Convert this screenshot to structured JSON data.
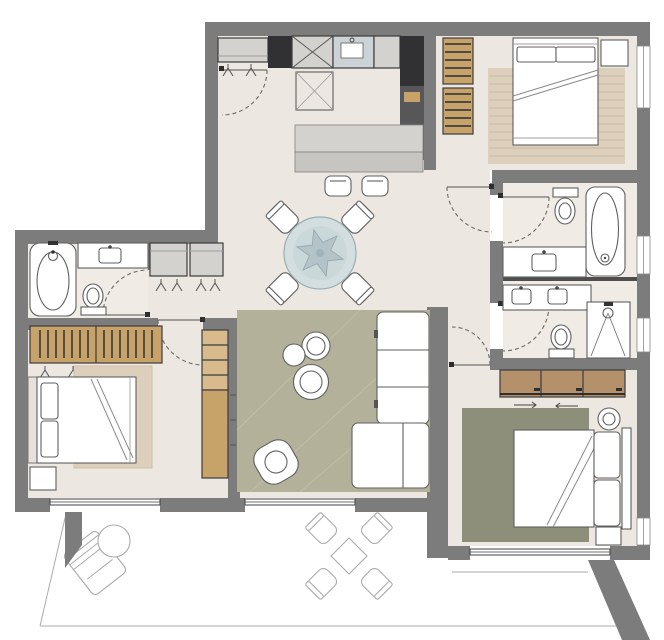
{
  "image": {
    "description": "Top-down architectural floor plan of a three-bedroom apartment with open kitchen-dining-living area, three bathrooms, and a wide terrace along the bottom; rendered with gray walls, cream floors, colored rugs and outlined furniture; no text labels visible",
    "width_px": 664,
    "height_px": 640
  },
  "colors": {
    "wall": "#7c7c7c",
    "wall_dark": "#4e4e4e",
    "floor": "#ece7e0",
    "bath_floor": "#f0ebe4",
    "rug_living": "#b4b19b",
    "rug_master": "#8e8f7b",
    "rug_beige": "#dccfbb",
    "rug_stripe": "#cdbfa7",
    "wood": "#c7a269",
    "wood_light": "#d9ba8c",
    "dresser_wood": "#b5916b",
    "cabinet_dark": "#313133",
    "cabinet_mid": "#57575a",
    "cabinet_gray": "#d4d2ce",
    "cabinet_low": "#c7c5c1",
    "sink_blue": "#cbd3d7",
    "headboard": "#e6e1da",
    "table_top": "#d3dee0",
    "table_inner": "#cbd8da",
    "table_star": "#b4c3c8",
    "glass_line": "#3f3f3f",
    "white": "#ffffff"
  },
  "rooms": [
    {
      "name": "entry-kitchen",
      "features": [
        "entry-door",
        "entry-bench-closet",
        "coat-hooks",
        "refrigerator-column",
        "tall-oven-cabinet-x2",
        "sink-unit",
        "counter",
        "tall-dark-cabinet-column",
        "kitchen-island",
        "bar-stool",
        "bar-stool"
      ]
    },
    {
      "name": "dining-area",
      "features": [
        "round-dining-table-with-star-inlay",
        "dining-chair",
        "dining-chair",
        "dining-chair",
        "dining-chair"
      ]
    },
    {
      "name": "living-area",
      "features": [
        "olive-area-rug",
        "l-shaped-sofa",
        "nesting-coffee-table",
        "nesting-coffee-table",
        "nesting-coffee-table",
        "armchair",
        "terrace-glazing"
      ]
    },
    {
      "name": "bedroom-top-right",
      "features": [
        "double-bed",
        "pillow",
        "pillow",
        "striped-beige-rug",
        "wardrobe-hanging-clothes-x2",
        "nightstand",
        "window"
      ]
    },
    {
      "name": "bathroom-upper-right",
      "features": [
        "toilet",
        "bathtub",
        "vanity-sink",
        "door",
        "window"
      ]
    },
    {
      "name": "shower-room-right",
      "features": [
        "double-vanity",
        "toilet",
        "shower",
        "door",
        "window"
      ]
    },
    {
      "name": "master-bedroom-bottom-right",
      "features": [
        "three-door-dresser",
        "double-bed",
        "pillow",
        "pillow",
        "dark-olive-rug",
        "round-stool",
        "nightstand",
        "terrace-glazing",
        "window"
      ]
    },
    {
      "name": "bedroom-left",
      "features": [
        "wardrobe-hanging-clothes-x2",
        "coat-hooks",
        "double-bed",
        "pillow",
        "pillow",
        "beige-rug",
        "nightstand",
        "shelving-desk-unit",
        "terrace-window"
      ]
    },
    {
      "name": "bathroom-left",
      "features": [
        "bathtub",
        "vanity-sink",
        "toilet",
        "door"
      ]
    },
    {
      "name": "hallway-closets",
      "features": [
        "built-in-closet",
        "built-in-closet",
        "coat-hooks"
      ]
    },
    {
      "name": "terrace",
      "features": [
        "lounge-chair",
        "round-side-table",
        "square-outdoor-table",
        "outdoor-chair",
        "outdoor-chair",
        "outdoor-chair",
        "outdoor-chair",
        "diagonal-boundary-walls"
      ]
    }
  ]
}
